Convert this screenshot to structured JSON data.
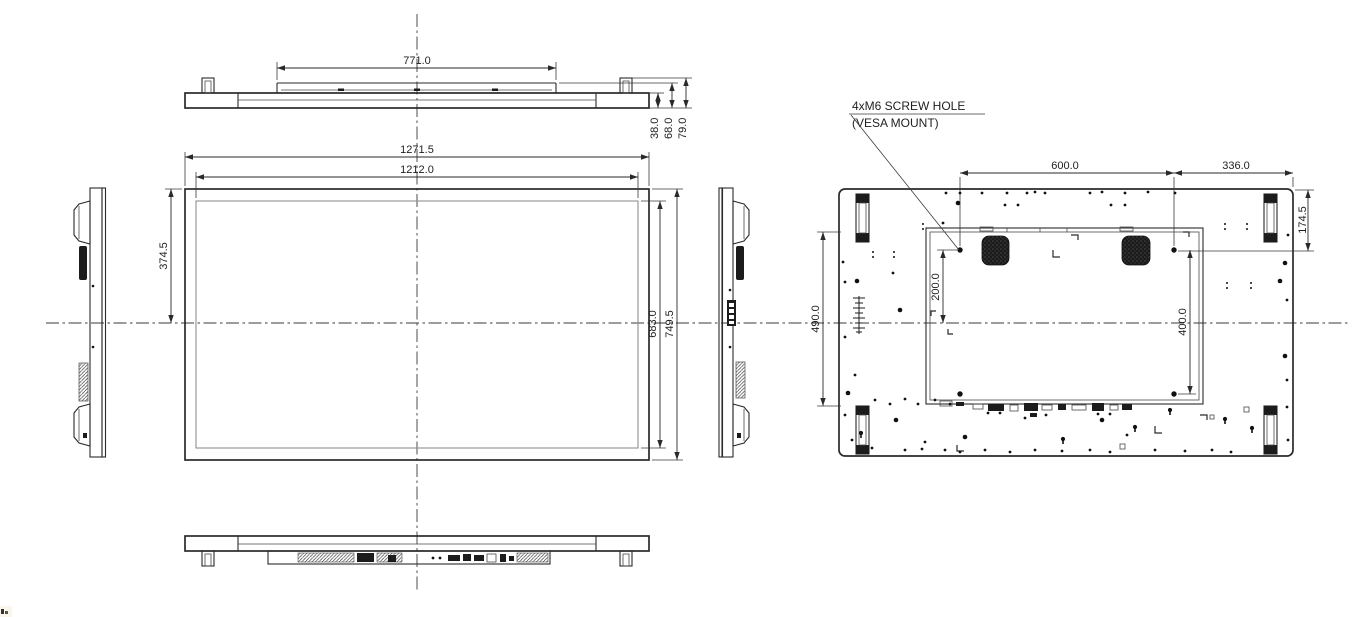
{
  "colors": {
    "background": "#ffffff",
    "line": "#2a2a2a",
    "inner_rect": "#8f8f8f",
    "dark_fill": "#1c1c1c"
  },
  "annotation": {
    "screw_note_line1": "4xM6 SCREW HOLE",
    "screw_note_line2": "(VESA MOUNT)"
  },
  "dimensions": {
    "top_view": {
      "mount_plate_width": "771.0",
      "panel_depth": "38.0",
      "mid_depth": "68.0",
      "total_depth": "79.0"
    },
    "front_view": {
      "overall_width": "1271.5",
      "display_width": "1212.0",
      "top_to_center_height": "374.5",
      "display_height": "683.0",
      "overall_height": "749.5"
    },
    "back_view": {
      "vesa_hole_spacing_x": "600.0",
      "vesa_to_edge": "336.0",
      "top_to_vesa": "174.5",
      "handle_spacing": "490.0",
      "vesa_to_center": "200.0",
      "vesa_hole_spacing_y": "400.0"
    }
  }
}
